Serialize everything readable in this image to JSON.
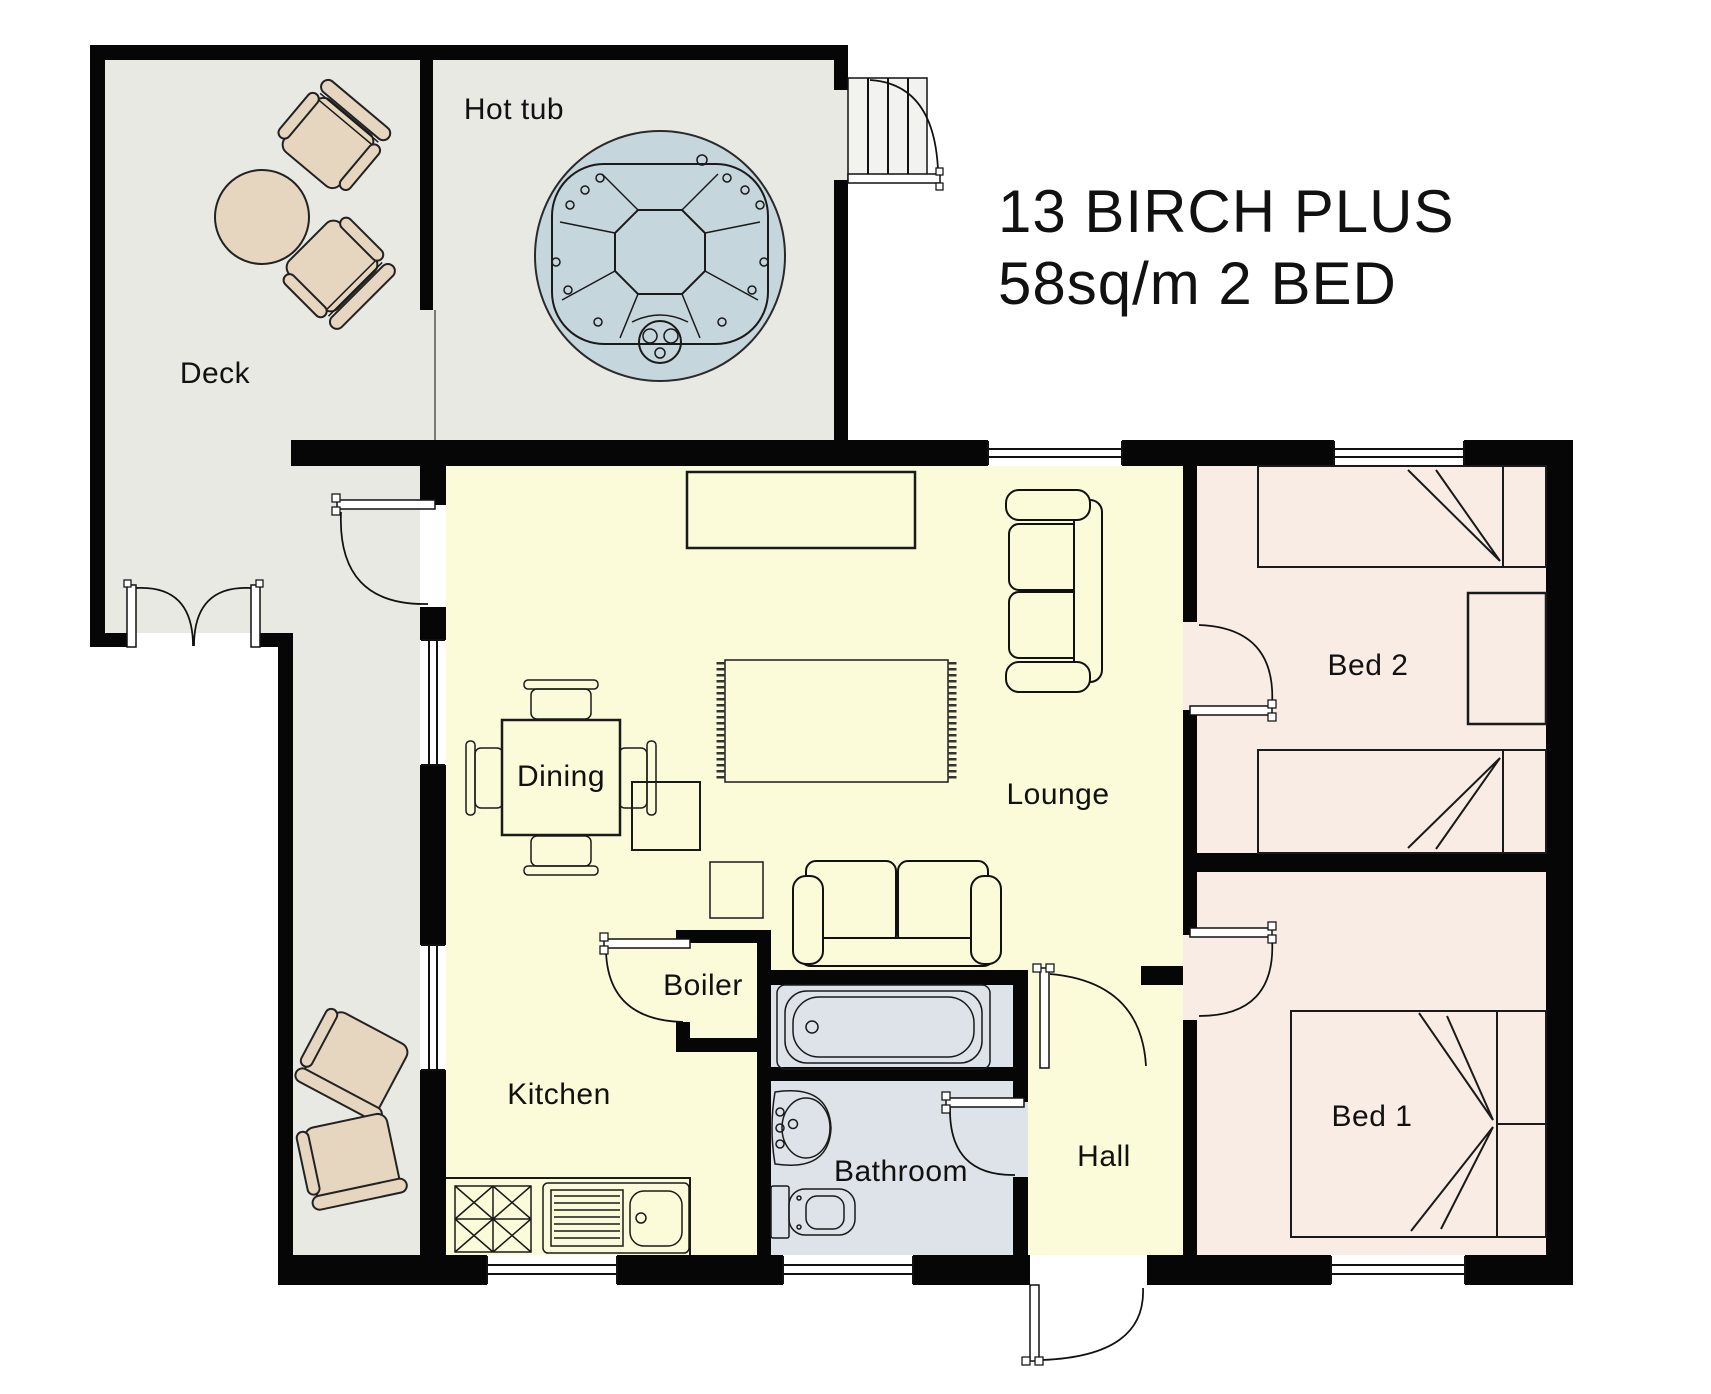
{
  "title": {
    "line1": "13 BIRCH PLUS",
    "line2": "58sq/m 2 BED"
  },
  "rooms": {
    "hot_tub": "Hot tub",
    "deck": "Deck",
    "dining": "Dining",
    "lounge": "Lounge",
    "kitchen": "Kitchen",
    "boiler": "Boiler",
    "bathroom": "Bathroom",
    "hall": "Hall",
    "bed1": "Bed 1",
    "bed2": "Bed 2"
  },
  "colors": {
    "wall": "#060606",
    "outdoor_floor": "#e9e9e4",
    "indoor_floor": "#fbfbda",
    "bedroom_floor": "#f9ece4",
    "bathroom_floor": "#dde3e9",
    "furniture_wood": "#e6d6bf",
    "hot_tub_water": "#c5d6dd"
  }
}
